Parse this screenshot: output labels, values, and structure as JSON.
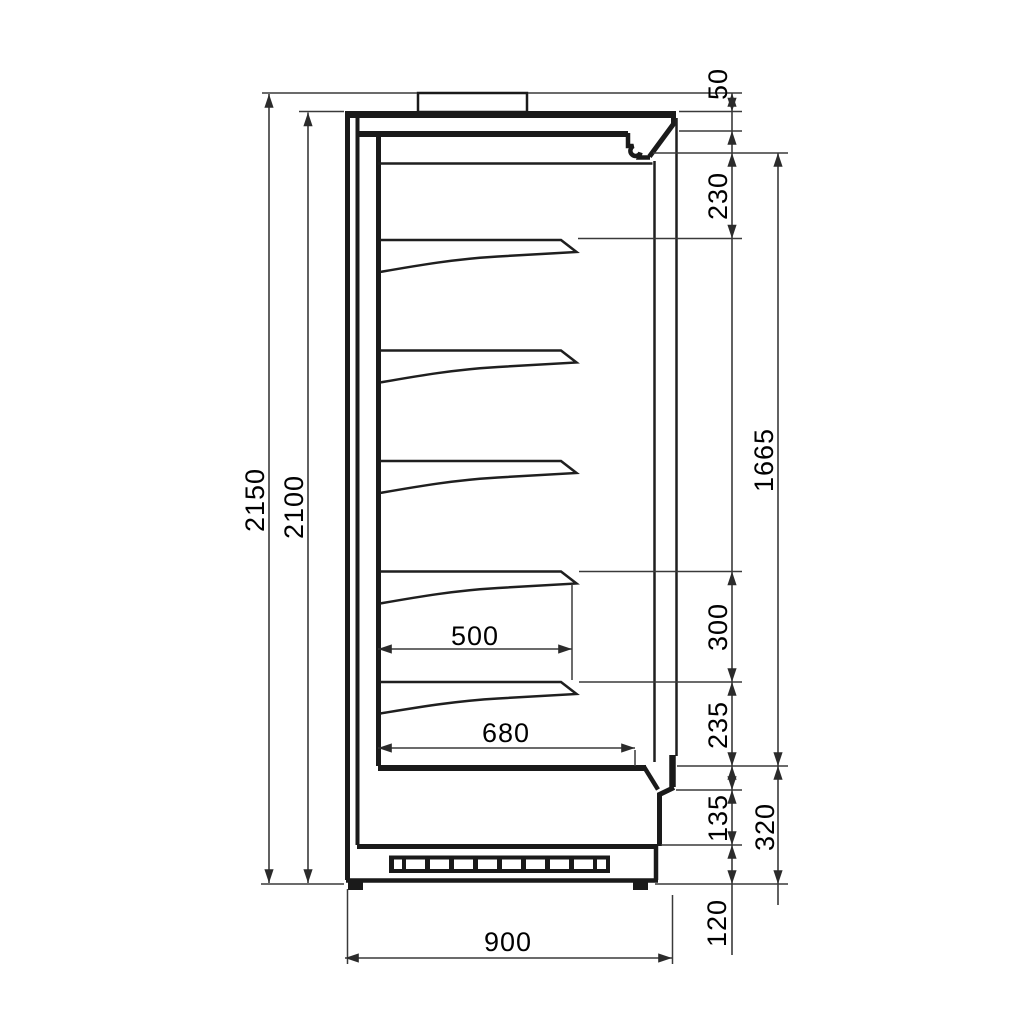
{
  "meta": {
    "drawing_kind": "side-section technical drawing",
    "subject": "vertical multideck refrigerated display cabinet",
    "background": "#ffffff",
    "line_color": "#1a1a1a",
    "dim_color": "#3a3a3a",
    "shelf_count": 5,
    "grille_slot_count": 10
  },
  "dims": {
    "overall_height": "2150",
    "case_height": "2100",
    "top_block": "50",
    "canopy_to_first_shelf": "230",
    "opening_height": "1665",
    "shelf_pitch": "300",
    "last_shelf_to_deck": "235",
    "shelf_depth": "500",
    "deck_depth": "680",
    "overall_depth": "900",
    "sill_height": "135",
    "base_height": "320",
    "plinth_height": "120"
  }
}
